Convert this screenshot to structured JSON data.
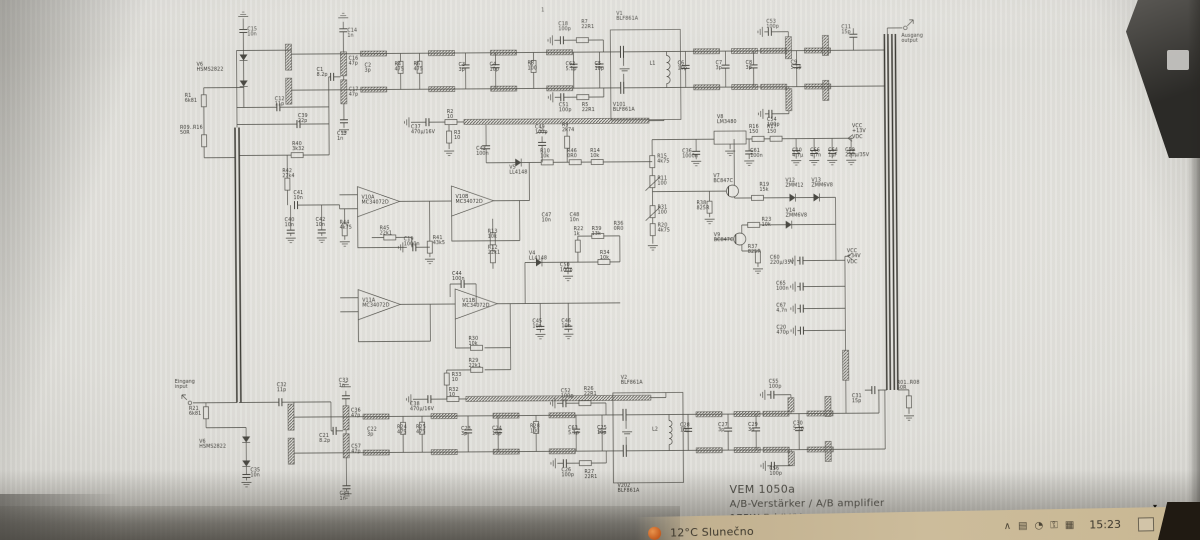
{
  "title_block": {
    "model": "VEM 1050a",
    "description": "A/B-Verstärker / A/B amplifier",
    "power_class": "175W  Bd.IV/V"
  },
  "colors": {
    "paper": "#e3e2dd",
    "ink": "#4a4943",
    "taskbar": "#c9b894",
    "weather_icon": "#c45a1d"
  },
  "taskbar": {
    "weather": "12°C Slunečno",
    "tray": [
      "∧",
      "▤",
      "◔",
      "⚿",
      "▦"
    ],
    "time": "15:23",
    "hide_arrow": "▾"
  },
  "schematic": {
    "components": [
      {
        "ref": "C15",
        "val": "10n",
        "x": 249,
        "y": 25
      },
      {
        "ref": "V6",
        "val": "HSMS2822",
        "x": 198,
        "y": 60
      },
      {
        "ref": "R1",
        "val": "6k81",
        "x": 186,
        "y": 91
      },
      {
        "ref": "R09..R16",
        "val": "50R",
        "x": 181,
        "y": 123
      },
      {
        "ref": "C12",
        "val": "11p",
        "x": 276,
        "y": 95
      },
      {
        "ref": "C39",
        "val": "22p",
        "x": 299,
        "y": 112
      },
      {
        "ref": "R40",
        "val": "3k32",
        "x": 293,
        "y": 140
      },
      {
        "ref": "R42",
        "val": "27k4",
        "x": 283,
        "y": 167
      },
      {
        "ref": "C41",
        "val": "10n",
        "x": 294,
        "y": 189
      },
      {
        "ref": "C40",
        "val": "10n",
        "x": 285,
        "y": 216
      },
      {
        "ref": "C42",
        "val": "10n",
        "x": 316,
        "y": 216
      },
      {
        "ref": "C13",
        "val": "1n",
        "x": 338,
        "y": 130
      },
      {
        "ref": "C14",
        "val": "1n",
        "x": 349,
        "y": 27
      },
      {
        "ref": "C1",
        "val": "8.2p",
        "x": 318,
        "y": 66
      },
      {
        "ref": "C16",
        "val": "47p",
        "x": 350,
        "y": 55
      },
      {
        "ref": "C17",
        "val": "47p",
        "x": 350,
        "y": 86
      },
      {
        "ref": "C2",
        "val": "3p",
        "x": 366,
        "y": 62
      },
      {
        "ref": "R4",
        "val": "475",
        "x": 396,
        "y": 61
      },
      {
        "ref": "R6",
        "val": "475",
        "x": 415,
        "y": 61
      },
      {
        "ref": "C3",
        "val": "3p",
        "x": 460,
        "y": 62
      },
      {
        "ref": "C4",
        "val": "10p",
        "x": 491,
        "y": 62
      },
      {
        "ref": "R8",
        "val": "100",
        "x": 529,
        "y": 61
      },
      {
        "ref": "C62",
        "val": "5.1p",
        "x": 567,
        "y": 62
      },
      {
        "ref": "C5",
        "val": "10p",
        "x": 596,
        "y": 62
      },
      {
        "ref": "C18",
        "val": "100p",
        "x": 560,
        "y": 22
      },
      {
        "ref": "R7",
        "val": "22R1",
        "x": 583,
        "y": 20
      },
      {
        "ref": "C51",
        "val": "100p",
        "x": 560,
        "y": 103
      },
      {
        "ref": "R5",
        "val": "22R1",
        "x": 583,
        "y": 103
      },
      {
        "ref": "V1",
        "val": "BLF861A",
        "x": 618,
        "y": 12
      },
      {
        "ref": "V101",
        "val": "BLF861A",
        "x": 614,
        "y": 103
      },
      {
        "ref": "L1",
        "val": "",
        "x": 651,
        "y": 62
      },
      {
        "ref": "C53",
        "val": "100p",
        "x": 768,
        "y": 21
      },
      {
        "ref": "C54",
        "val": "100p",
        "x": 768,
        "y": 119
      },
      {
        "ref": "C6",
        "val": "10p",
        "x": 679,
        "y": 62
      },
      {
        "ref": "C7",
        "val": "3p",
        "x": 717,
        "y": 62
      },
      {
        "ref": "C8",
        "val": "3p",
        "x": 747,
        "y": 62
      },
      {
        "ref": "C9",
        "val": "5.1p",
        "x": 792,
        "y": 62
      },
      {
        "ref": "C11",
        "val": "15p",
        "x": 843,
        "y": 27
      },
      {
        "ref": "Ausgang",
        "val": "output",
        "x": 903,
        "y": 36
      },
      {
        "ref": "C31",
        "val": "15p",
        "x": 851,
        "y": 396
      },
      {
        "ref": "R01..R08",
        "val": "50R",
        "x": 896,
        "y": 383
      },
      {
        "ref": "C37",
        "val": "470µ/16V",
        "x": 412,
        "y": 124
      },
      {
        "ref": "R2",
        "val": "10",
        "x": 448,
        "y": 109
      },
      {
        "ref": "R3",
        "val": "10",
        "x": 455,
        "y": 130
      },
      {
        "ref": "C43",
        "val": "100n",
        "x": 477,
        "y": 146
      },
      {
        "ref": "V5",
        "val": "LL4148",
        "x": 510,
        "y": 165
      },
      {
        "ref": "C49",
        "val": "100p",
        "x": 536,
        "y": 125
      },
      {
        "ref": "R9",
        "val": "2k74",
        "x": 563,
        "y": 123
      },
      {
        "ref": "R10",
        "val": "10k",
        "x": 541,
        "y": 149
      },
      {
        "ref": "R46",
        "val": "0R0",
        "x": 568,
        "y": 149
      },
      {
        "ref": "R14",
        "val": "10k",
        "x": 591,
        "y": 149
      },
      {
        "ref": "V10A",
        "val": "MC34072D",
        "x": 362,
        "y": 194
      },
      {
        "ref": "V10B",
        "val": "MC34072D",
        "x": 456,
        "y": 194
      },
      {
        "ref": "R44",
        "val": "4k75",
        "x": 340,
        "y": 219
      },
      {
        "ref": "R45",
        "val": "22k1",
        "x": 380,
        "y": 225
      },
      {
        "ref": "C19",
        "val": "1000n",
        "x": 404,
        "y": 236
      },
      {
        "ref": "R41",
        "val": "43k5",
        "x": 433,
        "y": 235
      },
      {
        "ref": "R13",
        "val": "10k",
        "x": 488,
        "y": 229
      },
      {
        "ref": "R12",
        "val": "22k1",
        "x": 488,
        "y": 245
      },
      {
        "ref": "C47",
        "val": "10n",
        "x": 542,
        "y": 213
      },
      {
        "ref": "C48",
        "val": "10n",
        "x": 570,
        "y": 213
      },
      {
        "ref": "R22",
        "val": "1k",
        "x": 574,
        "y": 227
      },
      {
        "ref": "R39",
        "val": "13k",
        "x": 592,
        "y": 227
      },
      {
        "ref": "R34",
        "val": "10k",
        "x": 600,
        "y": 251
      },
      {
        "ref": "V4",
        "val": "LL4148",
        "x": 529,
        "y": 251
      },
      {
        "ref": "C50",
        "val": "100p",
        "x": 560,
        "y": 263
      },
      {
        "ref": "V11A",
        "val": "MC34072D",
        "x": 362,
        "y": 297
      },
      {
        "ref": "V11B",
        "val": "MC34072D",
        "x": 462,
        "y": 298
      },
      {
        "ref": "C44",
        "val": "100n",
        "x": 452,
        "y": 271
      },
      {
        "ref": "R30",
        "val": "10k",
        "x": 468,
        "y": 336
      },
      {
        "ref": "R29",
        "val": "22k1",
        "x": 468,
        "y": 358
      },
      {
        "ref": "R33",
        "val": "10",
        "x": 451,
        "y": 372
      },
      {
        "ref": "C45",
        "val": "10n",
        "x": 532,
        "y": 319
      },
      {
        "ref": "C46",
        "val": "10n",
        "x": 561,
        "y": 319
      },
      {
        "ref": "R15",
        "val": "4k75",
        "x": 658,
        "y": 155
      },
      {
        "ref": "R11",
        "val": "100",
        "x": 658,
        "y": 177
      },
      {
        "ref": "R31",
        "val": "100",
        "x": 658,
        "y": 206
      },
      {
        "ref": "R20",
        "val": "4k75",
        "x": 658,
        "y": 224
      },
      {
        "ref": "R36",
        "val": "0R0",
        "x": 614,
        "y": 222
      },
      {
        "ref": "V8",
        "val": "LM3480",
        "x": 718,
        "y": 116
      },
      {
        "ref": "C36",
        "val": "1000n",
        "x": 683,
        "y": 150
      },
      {
        "ref": "C61",
        "val": "100n",
        "x": 751,
        "y": 150
      },
      {
        "ref": "R16",
        "val": "150",
        "x": 750,
        "y": 126
      },
      {
        "ref": "R17",
        "val": "150",
        "x": 768,
        "y": 126
      },
      {
        "ref": "C10",
        "val": "4,7µ",
        "x": 793,
        "y": 150
      },
      {
        "ref": "C66",
        "val": "4,7n",
        "x": 811,
        "y": 150
      },
      {
        "ref": "C64",
        "val": "1µF",
        "x": 829,
        "y": 150
      },
      {
        "ref": "C59",
        "val": "220µ/35V",
        "x": 846,
        "y": 150
      },
      {
        "ref": "VCC",
        "val": "+13V\nVDC",
        "x": 853,
        "y": 126
      },
      {
        "ref": "V7",
        "val": "BC847C",
        "x": 714,
        "y": 175
      },
      {
        "ref": "R38",
        "val": "825R",
        "x": 697,
        "y": 202
      },
      {
        "ref": "V9",
        "val": "BC847C",
        "x": 714,
        "y": 234
      },
      {
        "ref": "R19",
        "val": "15k",
        "x": 760,
        "y": 184
      },
      {
        "ref": "R23",
        "val": "10k",
        "x": 762,
        "y": 219
      },
      {
        "ref": "V12",
        "val": "ZMM12",
        "x": 786,
        "y": 180
      },
      {
        "ref": "V13",
        "val": "ZMM6V8",
        "x": 812,
        "y": 180
      },
      {
        "ref": "V14",
        "val": "ZMM6V8",
        "x": 786,
        "y": 210
      },
      {
        "ref": "R37",
        "val": "825R",
        "x": 748,
        "y": 246
      },
      {
        "ref": "C60",
        "val": "220µ/35V",
        "x": 770,
        "y": 257
      },
      {
        "ref": "VCC",
        "val": "+34V\nVDC",
        "x": 847,
        "y": 251
      },
      {
        "ref": "C65",
        "val": "100n",
        "x": 776,
        "y": 283
      },
      {
        "ref": "C67",
        "val": "4,7n",
        "x": 776,
        "y": 305
      },
      {
        "ref": "C20",
        "val": "470p",
        "x": 776,
        "y": 327
      },
      {
        "ref": "Eingang",
        "val": "input",
        "x": 174,
        "y": 377
      },
      {
        "ref": "R21",
        "val": "6k81",
        "x": 188,
        "y": 404
      },
      {
        "ref": "V6",
        "val": "HSMS2822",
        "x": 198,
        "y": 437
      },
      {
        "ref": "C35",
        "val": "10n",
        "x": 249,
        "y": 466
      },
      {
        "ref": "C32",
        "val": "11p",
        "x": 276,
        "y": 381
      },
      {
        "ref": "C33",
        "val": "1n",
        "x": 338,
        "y": 377
      },
      {
        "ref": "C36",
        "val": "47p",
        "x": 350,
        "y": 407
      },
      {
        "ref": "C21",
        "val": "8.2p",
        "x": 318,
        "y": 432
      },
      {
        "ref": "C57",
        "val": "47p",
        "x": 350,
        "y": 443
      },
      {
        "ref": "C22",
        "val": "3p",
        "x": 366,
        "y": 426
      },
      {
        "ref": "R24",
        "val": "475",
        "x": 396,
        "y": 424
      },
      {
        "ref": "R25",
        "val": "475",
        "x": 415,
        "y": 424
      },
      {
        "ref": "C23",
        "val": "3p",
        "x": 460,
        "y": 426
      },
      {
        "ref": "C24",
        "val": "10p",
        "x": 491,
        "y": 426
      },
      {
        "ref": "R28",
        "val": "100",
        "x": 529,
        "y": 424
      },
      {
        "ref": "C63",
        "val": "5.1p",
        "x": 567,
        "y": 426
      },
      {
        "ref": "C25",
        "val": "10p",
        "x": 596,
        "y": 426
      },
      {
        "ref": "C52",
        "val": "100p",
        "x": 560,
        "y": 389
      },
      {
        "ref": "R26",
        "val": "22R1",
        "x": 583,
        "y": 387
      },
      {
        "ref": "C26",
        "val": "100p",
        "x": 560,
        "y": 468
      },
      {
        "ref": "R27",
        "val": "22R1",
        "x": 583,
        "y": 470
      },
      {
        "ref": "V2",
        "val": "BLF861A",
        "x": 620,
        "y": 376
      },
      {
        "ref": "V202",
        "val": "BLF861A",
        "x": 616,
        "y": 484
      },
      {
        "ref": "L2",
        "val": "",
        "x": 651,
        "y": 428
      },
      {
        "ref": "C38",
        "val": "470µ/16V",
        "x": 409,
        "y": 401
      },
      {
        "ref": "R32",
        "val": "10",
        "x": 448,
        "y": 387
      },
      {
        "ref": "C28",
        "val": "10p",
        "x": 679,
        "y": 424
      },
      {
        "ref": "C27",
        "val": "3p",
        "x": 717,
        "y": 424
      },
      {
        "ref": "C29",
        "val": "3p",
        "x": 747,
        "y": 424
      },
      {
        "ref": "C30",
        "val": "5.1p",
        "x": 792,
        "y": 423
      },
      {
        "ref": "C55",
        "val": "100p",
        "x": 768,
        "y": 381
      },
      {
        "ref": "C56",
        "val": "100p",
        "x": 768,
        "y": 468
      },
      {
        "ref": "C34",
        "val": "1n",
        "x": 338,
        "y": 490
      },
      {
        "ref": "1",
        "val": "",
        "x": 543,
        "y": 8
      }
    ]
  }
}
